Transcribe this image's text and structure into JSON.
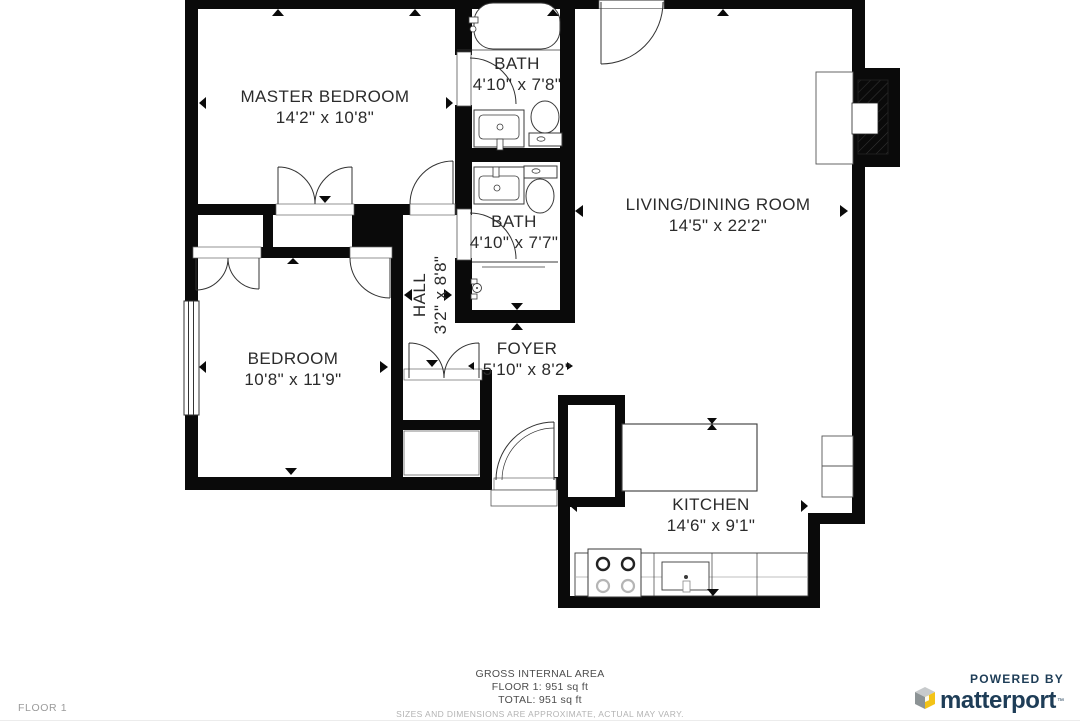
{
  "rooms": [
    {
      "name": "MASTER BEDROOM",
      "dims": "14'2\" x 10'8\""
    },
    {
      "name": "BATH",
      "dims": "4'10\" x 7'8\""
    },
    {
      "name": "LIVING/DINING ROOM",
      "dims": "14'5\" x 22'2\""
    },
    {
      "name": "BATH",
      "dims": "4'10\" x 7'7\""
    },
    {
      "name": "HALL",
      "dims": "3'2\" x 8'8\""
    },
    {
      "name": "BEDROOM",
      "dims": "10'8\" x 11'9\""
    },
    {
      "name": "FOYER",
      "dims": "5'10\" x 8'2\""
    },
    {
      "name": "KITCHEN",
      "dims": "14'6\" x 9'1\""
    }
  ],
  "footer": {
    "area_title": "GROSS INTERNAL AREA",
    "floor_area": "FLOOR 1: 951 sq ft",
    "total_area": "TOTAL: 951 sq ft",
    "disclaimer": "SIZES AND DIMENSIONS ARE APPROXIMATE, ACTUAL MAY VARY."
  },
  "floor_label": "FLOOR 1",
  "branding": {
    "powered_by": "POWERED BY",
    "brand": "matterport",
    "trademark": "™",
    "brand_color": "#1e3d57",
    "cube_top": "#c7cacc",
    "cube_left": "#8c9395",
    "cube_front": "#f3c317"
  },
  "colors": {
    "wall": "#0a0a0a",
    "fixture_stroke": "#3a3a3a",
    "label_text": "#2b2b2b",
    "footer_text": "#4d4d4d",
    "muted_text": "#b3b3b3"
  }
}
